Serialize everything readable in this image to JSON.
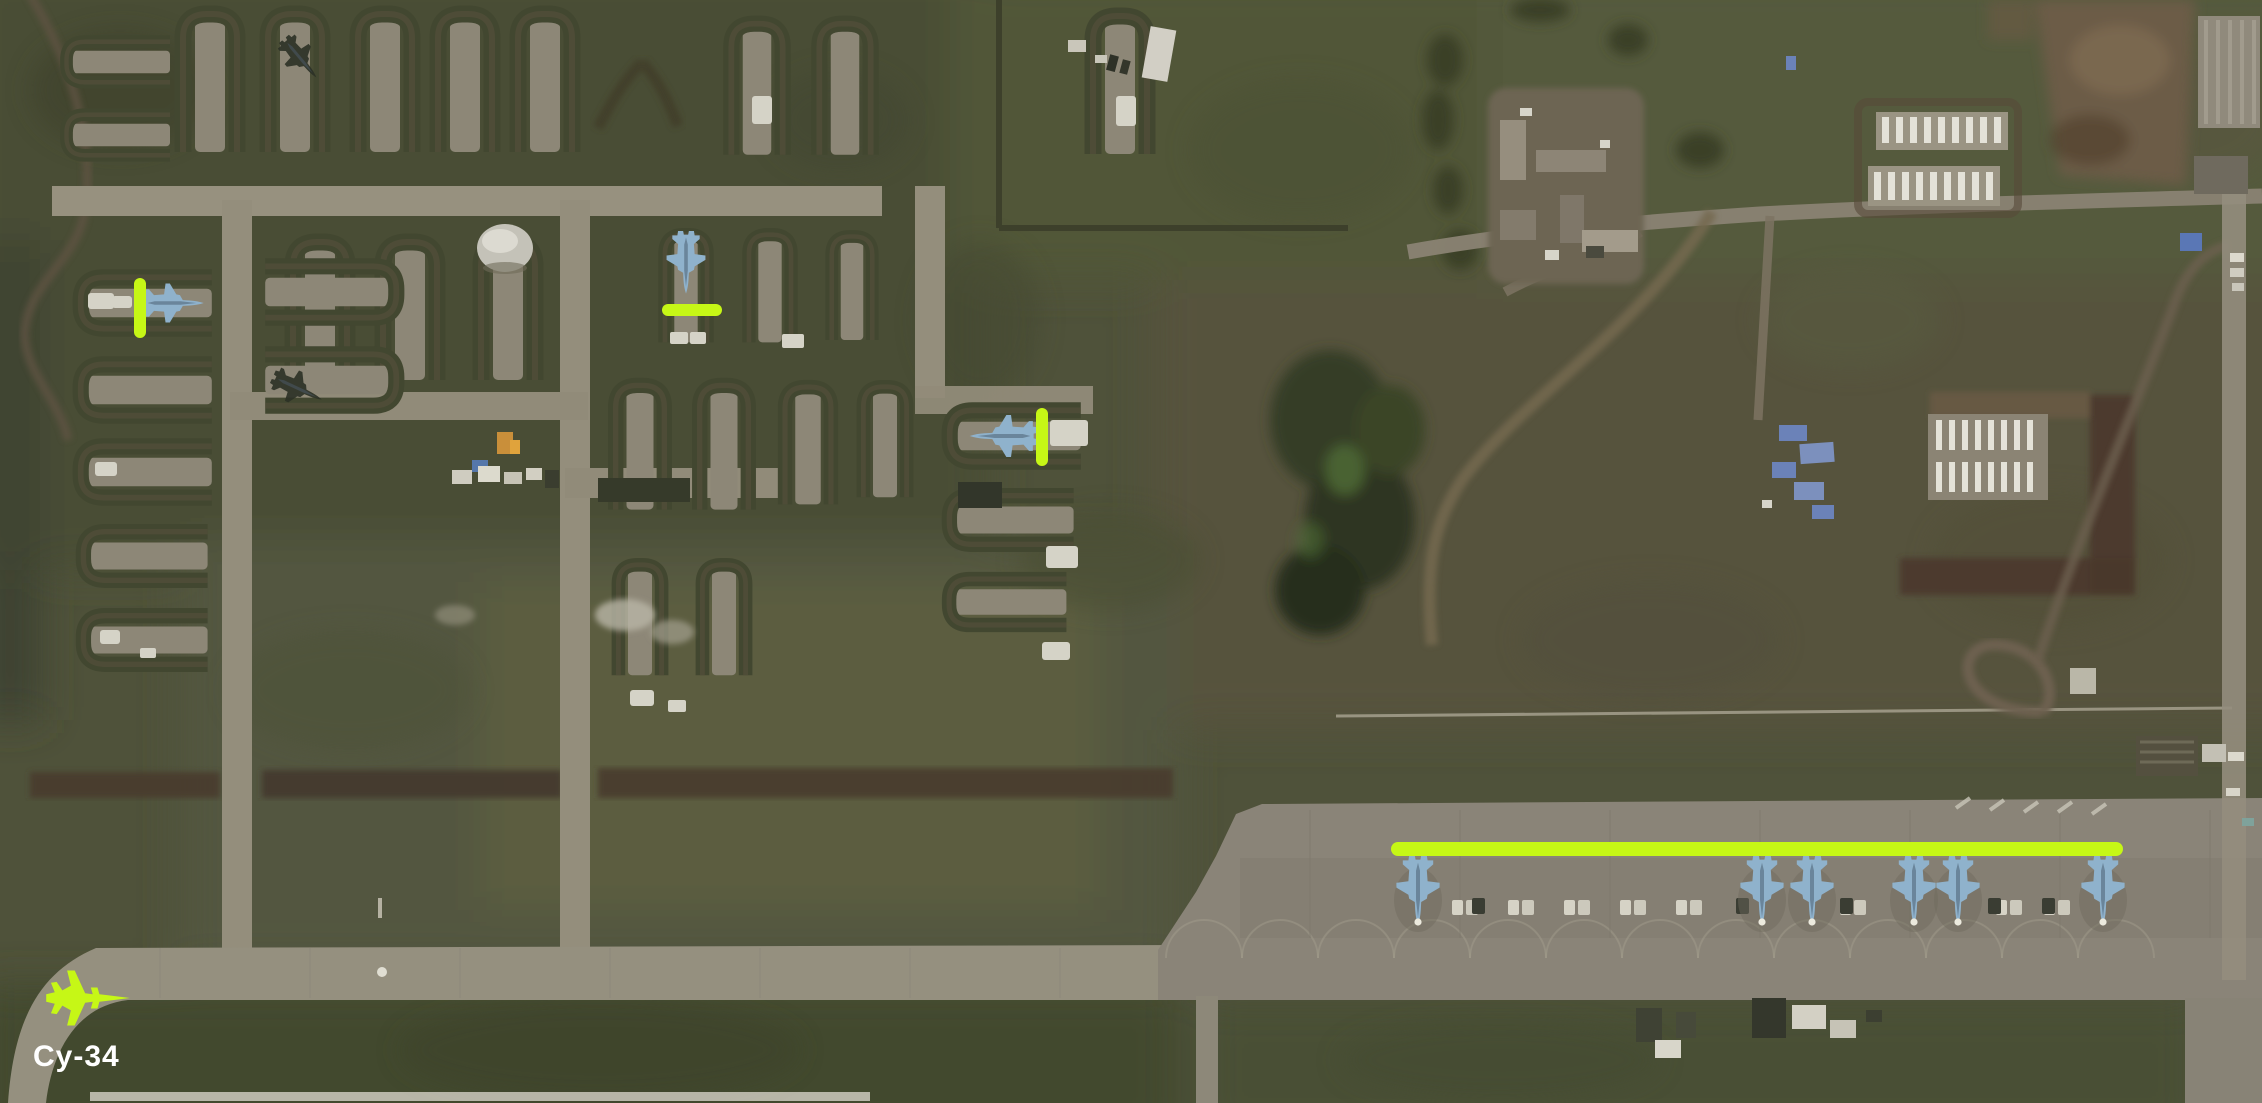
{
  "legend": {
    "label": "Су-34",
    "text_color": "#ffffff",
    "icon": "fighter-jet-silhouette"
  },
  "annotations": {
    "color": "#c6f716",
    "markers": [
      {
        "id": "revetment-aircraft-1",
        "orientation": "vertical",
        "x1": 140,
        "y1": 284,
        "x2": 140,
        "y2": 332,
        "width": 12
      },
      {
        "id": "revetment-aircraft-2",
        "orientation": "horizontal",
        "x1": 668,
        "y1": 310,
        "x2": 716,
        "y2": 310,
        "width": 12
      },
      {
        "id": "revetment-aircraft-3",
        "orientation": "vertical",
        "x1": 1042,
        "y1": 414,
        "x2": 1042,
        "y2": 460,
        "width": 12
      },
      {
        "id": "flightline-row",
        "orientation": "horizontal",
        "x1": 1398,
        "y1": 849,
        "x2": 2116,
        "y2": 849,
        "width": 14
      }
    ]
  },
  "aircraft": {
    "revetment_jets": [
      {
        "x": 172,
        "y": 303,
        "heading": "east",
        "scale": 0.72
      },
      {
        "x": 686,
        "y": 262,
        "heading": "south",
        "scale": 0.72
      },
      {
        "x": 1004,
        "y": 436,
        "heading": "west",
        "scale": 0.78
      }
    ],
    "dark_jets": [
      {
        "x": 300,
        "y": 58,
        "heading_deg": 140,
        "scale": 0.58
      },
      {
        "x": 297,
        "y": 388,
        "heading_deg": 115,
        "scale": 0.62
      }
    ],
    "flightline_jets": {
      "y": 890,
      "heading": "south",
      "scale": 0.8,
      "x_positions": [
        1418,
        1762,
        1812,
        1914,
        1958,
        2103
      ]
    }
  }
}
